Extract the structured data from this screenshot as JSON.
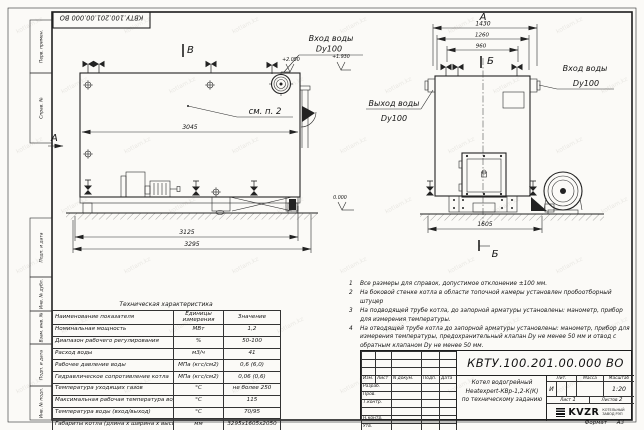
{
  "watermark": {
    "text": "kotlam.kz"
  },
  "stamp_top": {
    "doc_number": "КВТУ.100.201.00.000 ВО"
  },
  "frame": {
    "left_labels": [
      "Перв. примен.",
      "Справ. №",
      "Подп. и дата",
      "Инв. № дубл.",
      "Взам. инв. №",
      "Подп. и дата",
      "Инв. № подл."
    ],
    "format_label": "Формат",
    "format_value": "А3"
  },
  "side_view": {
    "view_letter_top": "В",
    "view_letter_left": "А",
    "callout": "см. п. 2",
    "dim_width_inner": "3045",
    "dim_width_skid": "3125",
    "dim_width_overall": "3295",
    "level_top": "+2.050",
    "level_inlet": "+1.930",
    "level_zero": "0.000",
    "inlet_label": "Вход воды",
    "inlet_size": "Dy100"
  },
  "front_view": {
    "view_letter": "А",
    "section_letter_top": "Б",
    "section_letter_bottom": "Б",
    "dim_overall": "1430",
    "dim_mid": "1260",
    "dim_inner": "960",
    "dim_base": "1605",
    "outlet_label": "Выход воды",
    "outlet_size": "Dy100",
    "inlet_label": "Вход воды",
    "inlet_size": "Dy100"
  },
  "spec_table": {
    "title": "Техническая характеристика",
    "col_name": "Наименование показателя",
    "col_units": "Единицы измерения",
    "col_value": "Значение",
    "rows": [
      [
        "Номинальная мощность",
        "МВт",
        "1,2"
      ],
      [
        "Диапазон рабочего регулирования",
        "%",
        "50-100"
      ],
      [
        "Расход воды",
        "м3/ч",
        "41"
      ],
      [
        "Рабочее давление воды",
        "МПа (кгс/см2)",
        "0,6 (6,0)"
      ],
      [
        "Гидравлическое сопротивление котла",
        "МПа (кгс/см2)",
        "0,06 (0,6)"
      ],
      [
        "Температура уходящих газов",
        "°С",
        "не более 250"
      ],
      [
        "Максимальная рабочая температура воды",
        "°С",
        "115"
      ],
      [
        "Температура воды (вход/выход)",
        "°С",
        "70/95"
      ],
      [
        "Габариты котла (длина х ширина х высота)",
        "мм",
        "3295х1605х2050"
      ]
    ]
  },
  "notes": [
    {
      "num": "1",
      "text": "Все размеры для справок, допустимое отклонение ±100 мм."
    },
    {
      "num": "2",
      "text": "На боковой стенке котла в области топочной камеры установлен пробоотборный штуцер"
    },
    {
      "num": "3",
      "text": "На подводящей трубе котла, до запорной арматуры установлены: манометр, прибор для измерения температуры."
    },
    {
      "num": "4",
      "text": "На отводящей трубе котла до запорной арматуры установлены: манометр, прибор для измерения температуры, предохранительный клапан Dy не менее 50 мм и отвод с обратным клапаном Dy не менее 50 мм."
    }
  ],
  "title_block": {
    "doc_number": "КВТУ.100.201.00.000 ВО",
    "header_cells": [
      "Изм.",
      "Лист",
      "N докум.",
      "Подп.",
      "Дата"
    ],
    "row_labels": [
      "Разраб.",
      "Пров.",
      "Т.контр.",
      "",
      "Н.контр.",
      "Утв."
    ],
    "title_lines": [
      "Котел водогрейный",
      "Heatexpert-КВр-1,2-К(К)",
      "по техническому заданию"
    ],
    "lit_header": "Лит.",
    "mass_header": "Масса",
    "scale_header": "Масштаб",
    "lit_value": "И",
    "scale_value": "1:20",
    "sheet_label": "Лист",
    "sheet_value": "1",
    "sheets_label": "Листов",
    "sheets_value": "2",
    "logo_text": "KVZR",
    "logo_sub1": "КОТЕЛЬНЫЙ",
    "logo_sub2": "ЗАВОД РЭП"
  }
}
